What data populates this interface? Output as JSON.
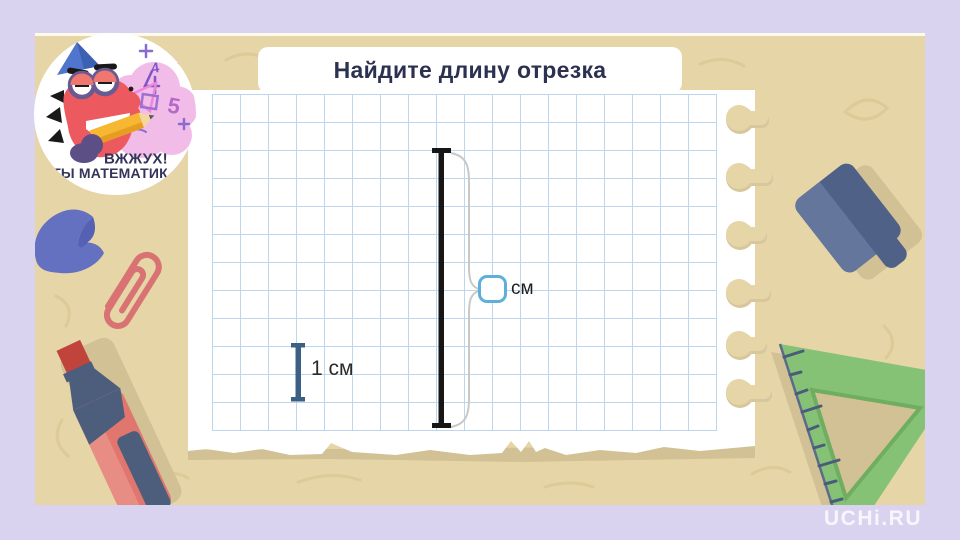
{
  "task": {
    "title": "Найдите длину отрезка",
    "unit_label": "см",
    "answer_value": "",
    "scale_label": "1 см"
  },
  "measurement": {
    "grid_cell_px": 28,
    "segment_length_cells": 10,
    "scale_segment_cells": 2,
    "scale_segment_cm": 1
  },
  "badge": {
    "line1": "ВЖЖУХ!",
    "line2": "ТЫ МАТЕМАТИК",
    "doodle_4": "4",
    "doodle_5": "5"
  },
  "brand": {
    "watermark": "UCHi.RU"
  },
  "icons": {
    "mascot": "dragon-party-hat-badge",
    "stationery": [
      "feather",
      "paperclip",
      "marker-pen",
      "board-eraser",
      "set-square-ruler"
    ]
  },
  "colors": {
    "frame": "#d9d3f0",
    "desk": "#e5d5a7",
    "paper": "#ffffff",
    "grid_line": "#bcd6ee",
    "segment": "#161616",
    "scale_segment": "#3d5f84",
    "input_border": "#5fb0d8",
    "brace": "#c8c8c8",
    "title_text": "#2c3150",
    "ruler_green": "#86c276",
    "slate": "#4d5e7d",
    "marker_red": "#e0766d",
    "badge_text": "#32345a"
  }
}
